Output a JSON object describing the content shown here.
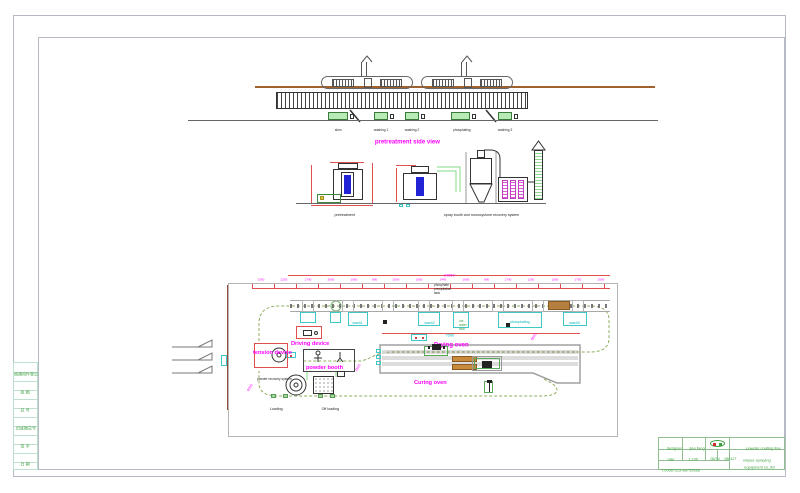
{
  "sheet": {
    "top_view": {
      "title": "pretreatment side view",
      "tank_labels": [
        "skim",
        "washing 1",
        "washing 2",
        "phosphating",
        "washing 3"
      ]
    },
    "section_views": {
      "left_label": "pretreatment",
      "right_label": "spray booth and monocyclone recovery system"
    },
    "plan_view": {
      "overall_dim": "24050",
      "segment_dims": [
        "1500",
        "2250",
        "1700",
        "3000",
        "1950",
        "800",
        "2000",
        "1000",
        "1445",
        "1600",
        "800",
        "1700",
        "1200",
        "1500",
        "1750",
        "2000"
      ],
      "note_lines": [
        "phosphate",
        "precipitation",
        "tank"
      ],
      "oven_dim": "7500",
      "diag_dims": [
        "4000",
        "1500",
        "8500"
      ],
      "labels": {
        "driving_device": "Driving device",
        "tension_device": "tension device",
        "powder_booth": "powder booth",
        "powder_recovery": "powder recovery system",
        "drying_oven": "Drying oven",
        "curing_oven": "Curing oven",
        "loading": "Loading",
        "off_loading": "Off loading"
      },
      "tank_labels": [
        "wash1",
        "wash2",
        "phosphating",
        "wash3"
      ],
      "hot_water_lines": [
        "hot",
        "water",
        "tank"
      ]
    },
    "side_column_rows": [
      "",
      "借通用件登记",
      "",
      "底 图",
      "",
      "总 号",
      "",
      "旧底图总号",
      "",
      "签 字",
      "",
      "日 期"
    ],
    "title_block": {
      "designer_label": "designer",
      "designer_name": "jiao fang",
      "rate_label": "rate",
      "rate_value": "1:100",
      "field_a": "06/7d",
      "field_b": "080127",
      "phone": "T:0086-523-88759666",
      "project": "powder coating line",
      "company_line1": "xinyue spraying",
      "company_line2": "equipment co.,ltd"
    },
    "colors": {
      "magenta": "#ff00ff",
      "cyan": "#00b8b8",
      "green_text": "#3f9f3f",
      "red_dim": "#e05050",
      "tank_green": "#b7eab4",
      "brown_rail": "#a0622d",
      "burner_brown": "#c98a3b",
      "blue_part": "#2323d6"
    }
  }
}
